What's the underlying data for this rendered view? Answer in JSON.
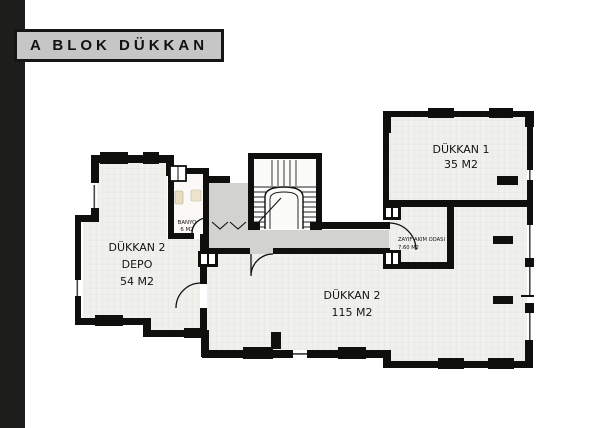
{
  "title": "A BLOK DÜKKAN",
  "rooms": {
    "dukkan1": {
      "name": "DÜKKAN 1",
      "area": "35 M2"
    },
    "dukkan2_depo": {
      "name": "DÜKKAN 2",
      "usage": "DEPO",
      "area": "54 M2"
    },
    "dukkan2": {
      "name": "DÜKKAN 2",
      "area": "115 M2"
    },
    "banyo": {
      "name": "BANYO",
      "area": "6 M2"
    },
    "zayif_akim_odasi": {
      "name": "ZAYIF AKIM ODASI",
      "area": "7.60 M2"
    }
  },
  "colors": {
    "background": "#ffffff",
    "sidebar_bar": "#1d1d1b",
    "title_box_bg": "#c6c6c6",
    "title_box_border": "#151515",
    "wall": "#0f0f0d",
    "room_fill": "#f0f0ed",
    "room_grid": "#dededa",
    "corridor_fill": "#d2d2d0",
    "stair_fill": "#fbfbf9",
    "fixture_beige": "#e7ddc0",
    "label_text": "#141414"
  }
}
